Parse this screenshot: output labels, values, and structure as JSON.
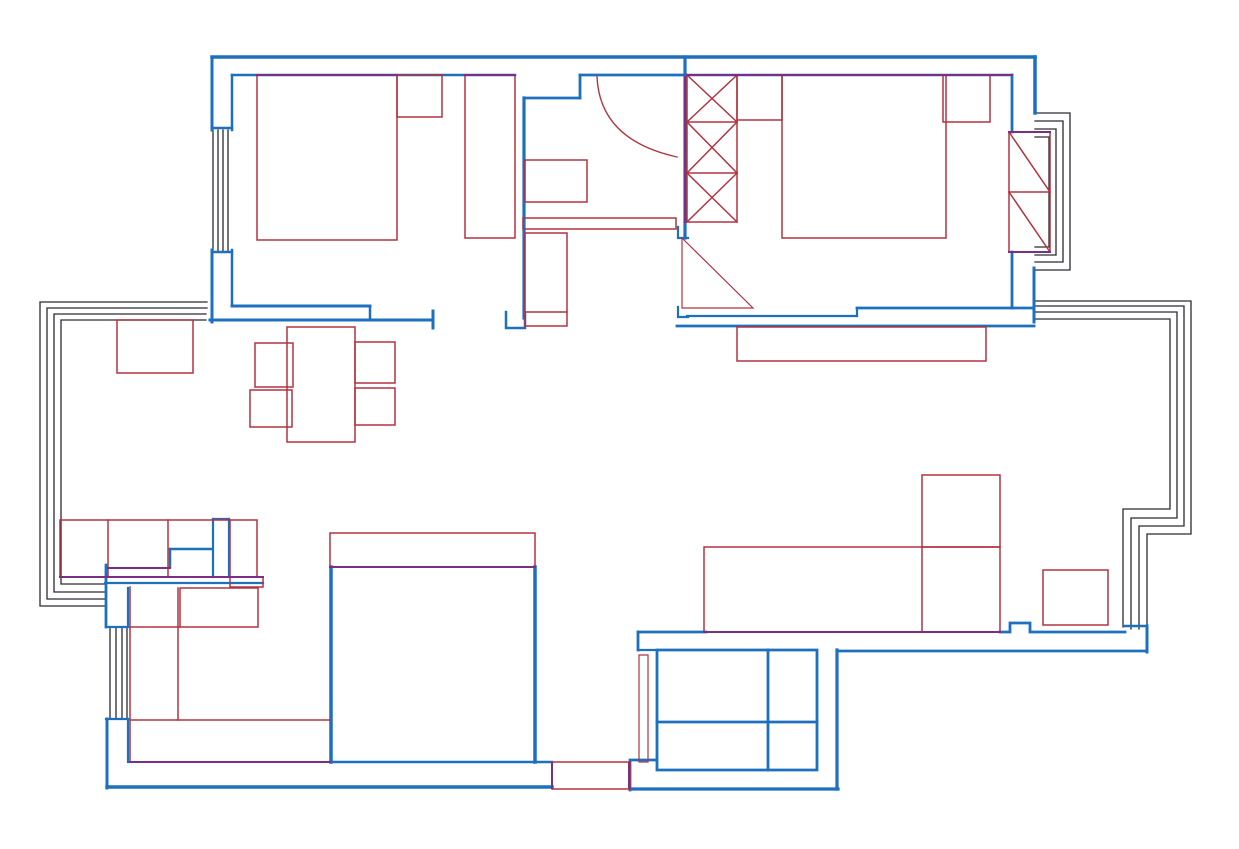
{
  "canvas": {
    "width": 1239,
    "height": 849,
    "background": "#ffffff"
  },
  "colors": {
    "wall": "#1d70bd",
    "furniture": "#b23340",
    "window": "#2a2a33",
    "overlap": "#7a2f84"
  },
  "layers": [
    {
      "name": "window-layer",
      "item_name": "window-line",
      "color_key": "window",
      "width": 1.3,
      "elements": [
        {
          "name": "living-bay-window-line",
          "d": "M 1034,301 H 1191 V 534 H 1147 V 629"
        },
        {
          "name": "living-bay-window-line",
          "d": "M 1034,306 H 1184 V 526 H 1139 V 629"
        },
        {
          "name": "living-bay-window-line",
          "d": "M 1034,312 H 1177 V 518 H 1131 V 629"
        },
        {
          "name": "living-bay-window-line",
          "d": "M 1034,319 H 1170 V 509 H 1123 V 627"
        },
        {
          "name": "dining-bay-window-line",
          "d": "M 207,302 H 40 V 606 H 106"
        },
        {
          "name": "dining-bay-window-line",
          "d": "M 207,308 H 47 V 599 H 106"
        },
        {
          "name": "dining-bay-window-line",
          "d": "M 206,314 H 54 V 592 H 106"
        },
        {
          "name": "dining-bay-window-line",
          "d": "M 206,320 H 61 V 584 H 106"
        },
        {
          "name": "bedroom1-window-line",
          "d": "M 213,130 V 251"
        },
        {
          "name": "bedroom1-window-line",
          "d": "M 218,130 V 251"
        },
        {
          "name": "bedroom1-window-line",
          "d": "M 223,130 V 251"
        },
        {
          "name": "bedroom1-window-line",
          "d": "M 228,130 V 251"
        },
        {
          "name": "kitchen-window-line",
          "d": "M 110,628 V 719"
        },
        {
          "name": "kitchen-window-line",
          "d": "M 116,628 V 719"
        },
        {
          "name": "kitchen-window-line",
          "d": "M 122,628 V 719"
        },
        {
          "name": "kitchen-window-line",
          "d": "M 127,628 V 719"
        },
        {
          "name": "bedroom2-bay-window-line",
          "d": "M 1035,113 H 1070 V 270 H 1035"
        },
        {
          "name": "bedroom2-bay-window-line",
          "d": "M 1035,121 H 1063 V 262 H 1035"
        },
        {
          "name": "bedroom2-bay-window-line",
          "d": "M 1035,129 H 1056 V 255 H 1035"
        },
        {
          "name": "bedroom2-bay-window-line",
          "d": "M 1035,137 H 1049 V 247 H 1035"
        }
      ]
    },
    {
      "name": "wall-layer",
      "item_name": "wall-segment",
      "color_key": "wall",
      "width": 3,
      "elements": [
        {
          "name": "outer-wall-top",
          "d": "M 212,57 H 1035",
          "w": 3.5
        },
        {
          "d": "M 212,57 V 130"
        },
        {
          "d": "M 212,250 V 322"
        },
        {
          "d": "M 232,75 H 515",
          "w": 2.5
        },
        {
          "d": "M 232,75 V 130",
          "w": 2.5
        },
        {
          "d": "M 232,250 V 306",
          "w": 2.5
        },
        {
          "d": "M 212,128 H 232",
          "w": 2.5
        },
        {
          "d": "M 212,252 H 232",
          "w": 2.5
        },
        {
          "name": "bedroom1-bottom-wall",
          "d": "M 232,306 H 370"
        },
        {
          "d": "M 370,306 V 320",
          "w": 2.5
        },
        {
          "d": "M 210,320 H 433"
        },
        {
          "d": "M 433,311 V 328"
        },
        {
          "name": "entry-wall",
          "d": "M 580,75 H 686",
          "w": 2.8
        },
        {
          "d": "M 580,75 V 98",
          "w": 2.8
        },
        {
          "d": "M 524,98 H 580",
          "w": 2.8
        },
        {
          "name": "hall-left-wall",
          "d": "M 524,98 V 318",
          "w": 3.2
        },
        {
          "d": "M 506,312 V 328 H 525 V 314",
          "w": 2.5
        },
        {
          "name": "hall-right-wall",
          "d": "M 685,57 V 238",
          "w": 3.2
        },
        {
          "d": "M 678,227 V 238 H 688",
          "w": 2.2
        },
        {
          "name": "bedroom2-top-wall",
          "d": "M 686,75 H 1012",
          "w": 2.5
        },
        {
          "d": "M 1012,75 V 132",
          "w": 2.8
        },
        {
          "d": "M 1012,252 V 308",
          "w": 2.8
        },
        {
          "d": "M 1035,57 V 113",
          "w": 3.5
        },
        {
          "d": "M 1034,268 V 322"
        },
        {
          "d": "M 1012,308 H 1034",
          "w": 2.8
        },
        {
          "name": "bedroom2-bottom-wall",
          "d": "M 687,316 H 857",
          "w": 2.2
        },
        {
          "d": "M 857,308 H 1012",
          "w": 2.8
        },
        {
          "d": "M 857,308 V 316",
          "w": 2.2
        },
        {
          "d": "M 677,326 H 1034",
          "w": 2.8
        },
        {
          "d": "M 678,307 V 317 H 688",
          "w": 2.2
        },
        {
          "name": "dining-partition-stub",
          "d": "M 213,519 H 229",
          "w": 2.2
        },
        {
          "d": "M 213,519 V 577",
          "w": 2.2
        },
        {
          "d": "M 229,519 V 577",
          "w": 2.2
        },
        {
          "d": "M 170,549 H 212",
          "w": 2.5
        },
        {
          "d": "M 170,549 V 567",
          "w": 2.5
        },
        {
          "d": "M 105,583 H 263",
          "w": 2.2
        },
        {
          "name": "kitchen-right-wall",
          "d": "M 331,567 V 762",
          "w": 3.5
        },
        {
          "name": "living-left-wall",
          "d": "M 535,567 V 762",
          "w": 3.5
        },
        {
          "d": "M 106,565 V 627",
          "w": 2.8
        },
        {
          "d": "M 128,588 V 627",
          "w": 2.2
        },
        {
          "d": "M 106,627 H 128",
          "w": 2.2
        },
        {
          "d": "M 106,719 H 128",
          "w": 2.2
        },
        {
          "d": "M 107,719 V 788"
        },
        {
          "d": "M 128,719 V 762",
          "w": 2.2
        },
        {
          "name": "outer-wall-bottom",
          "d": "M 107,787 H 552",
          "w": 3.5
        },
        {
          "d": "M 330,762 H 552",
          "w": 2.5
        },
        {
          "d": "M 630,790 V 760 H 657",
          "w": 2.8
        },
        {
          "name": "bathroom-bottom-wall",
          "d": "M 630,789 H 838",
          "w": 3.2
        },
        {
          "name": "bathroom-right-wall",
          "d": "M 837,650 V 789",
          "w": 3.2
        },
        {
          "d": "M 638,632 H 706",
          "w": 2.8
        },
        {
          "d": "M 638,632 V 650",
          "w": 2.8
        },
        {
          "d": "M 638,650 H 657",
          "w": 2.2
        },
        {
          "name": "shower-unit",
          "d": "M 657,650 H 817 V 770 H 657 Z",
          "w": 2.8
        },
        {
          "d": "M 768,650 V 770",
          "w": 2.8
        },
        {
          "d": "M 657,722 H 817",
          "w": 2.8
        },
        {
          "name": "living-bottom-wall",
          "d": "M 1000,632 H 1010 V 623 H 1030 V 632 H 1125",
          "w": 2.8
        },
        {
          "d": "M 1125,626 H 1147",
          "w": 2.5
        },
        {
          "d": "M 1147,626 V 652"
        },
        {
          "d": "M 837,651 H 1147",
          "w": 2.8
        }
      ]
    },
    {
      "name": "furniture-layer",
      "item_name": "furniture-outline",
      "color_key": "furniture",
      "width": 1.5,
      "elements": [
        {
          "name": "bedroom1-bed",
          "d": "M 257,75 H 397 V 240 H 257 Z"
        },
        {
          "name": "bedroom1-nightstand",
          "d": "M 397,75 H 442 V 117 H 397 Z"
        },
        {
          "name": "bedroom1-wardrobe",
          "d": "M 465,75 H 515 V 238 H 465 Z"
        },
        {
          "name": "bedroom2-nightstand-left",
          "d": "M 737,75 H 782 V 120 H 737 Z"
        },
        {
          "name": "bedroom2-bed",
          "d": "M 782,75 H 946 V 238 H 782 Z"
        },
        {
          "name": "bedroom2-nightstand-right",
          "d": "M 943,75 H 990 V 122 H 943 Z"
        },
        {
          "name": "bedroom2-radiator",
          "d": "M 1009,132 H 1050 V 252 H 1009 Z"
        },
        {
          "d": "M 1009,192 H 1050"
        },
        {
          "d": "M 1009,132 L 1050,192"
        },
        {
          "d": "M 1009,192 L 1050,252"
        },
        {
          "name": "hall-wardrobe",
          "d": "M 687,75 H 737 V 222 H 687 Z"
        },
        {
          "d": "M 687,122 H 737"
        },
        {
          "d": "M 687,173 H 737"
        },
        {
          "d": "M 687,75 L 737,122"
        },
        {
          "d": "M 737,75 L 687,122"
        },
        {
          "d": "M 687,122 L 737,173"
        },
        {
          "d": "M 737,122 L 687,173"
        },
        {
          "d": "M 687,173 L 737,222"
        },
        {
          "d": "M 737,173 L 687,222"
        },
        {
          "name": "hall-cabinet",
          "d": "M 525,160 H 587 V 202 H 525 Z"
        },
        {
          "name": "hall-threshold",
          "d": "M 523,218 H 676 V 229 H 523 Z"
        },
        {
          "name": "shoe-cabinet",
          "d": "M 525,233 H 567 V 326 H 525 Z"
        },
        {
          "d": "M 525,312 H 567"
        },
        {
          "name": "entry-door-arc",
          "d": "M 597,77 Q 600,140 677,157",
          "w": 1.4
        },
        {
          "name": "door-swing-triangle",
          "d": "M 682,238 V 308 H 753 Z",
          "w": 1.2
        },
        {
          "name": "tv-cabinet",
          "d": "M 737,327 H 986 V 361 H 737 Z"
        },
        {
          "name": "dining-sideboard",
          "d": "M 117,320 H 193 V 373 H 117 Z"
        },
        {
          "name": "dining-table",
          "d": "M 287,327 H 355 V 442 H 287 Z"
        },
        {
          "name": "dining-chair",
          "d": "M 255,343 H 293 V 387 H 255 Z"
        },
        {
          "name": "dining-chair",
          "d": "M 250,390 H 292 V 427 H 250 Z"
        },
        {
          "name": "dining-chair",
          "d": "M 355,342 H 395 V 383 H 355 Z"
        },
        {
          "name": "dining-chair",
          "d": "M 355,388 H 395 V 425 H 355 Z"
        },
        {
          "name": "dining-counter",
          "d": "M 60,520 H 257 V 577 H 60 Z"
        },
        {
          "d": "M 108,520 V 577"
        },
        {
          "d": "M 168,520 V 577"
        },
        {
          "d": "M 230,520 V 577"
        },
        {
          "d": "M 230,577 H 263 V 587 H 230 Z"
        },
        {
          "name": "bar-counter",
          "d": "M 330,533 H 535 V 567 H 330 Z"
        },
        {
          "name": "kitchen-counter-edge",
          "d": "M 130,587 V 762"
        },
        {
          "d": "M 178,588 V 720"
        },
        {
          "d": "M 130,720 H 330"
        },
        {
          "name": "kitchen-stove",
          "d": "M 180,588 H 258 V 627 H 180 Z"
        },
        {
          "d": "M 130,627 H 180"
        },
        {
          "name": "bathroom-threshold",
          "d": "M 552,762 H 630 V 789 H 552 Z"
        },
        {
          "name": "bathroom-door-leaf",
          "d": "M 639,655 H 648 V 762 H 639 Z",
          "w": 1.2
        },
        {
          "name": "sofa",
          "d": "M 704,547 H 1000 V 632 H 704 Z"
        },
        {
          "name": "sofa-chaise",
          "d": "M 922,475 H 1000 V 547 H 922 Z"
        },
        {
          "d": "M 922,547 V 632"
        },
        {
          "name": "side-table",
          "d": "M 1043,570 H 1108 V 625 H 1043 Z"
        }
      ]
    },
    {
      "name": "overlap-layer",
      "item_name": "overlap-line",
      "color_key": "overlap",
      "width": 2,
      "elements": [
        {
          "d": "M 257,75 H 397"
        },
        {
          "d": "M 465,75 H 515"
        },
        {
          "d": "M 687,75 H 1012"
        },
        {
          "d": "M 685,77 V 222"
        },
        {
          "d": "M 704,632 H 1000"
        },
        {
          "d": "M 330,567 H 535"
        },
        {
          "d": "M 60,577 H 263"
        },
        {
          "d": "M 108,568 H 170"
        },
        {
          "d": "M 130,762 H 330"
        },
        {
          "d": "M 1009,132 H 1050"
        },
        {
          "d": "M 1009,252 H 1050"
        },
        {
          "d": "M 552,763 V 788"
        },
        {
          "d": "M 629,763 V 788"
        }
      ]
    }
  ]
}
